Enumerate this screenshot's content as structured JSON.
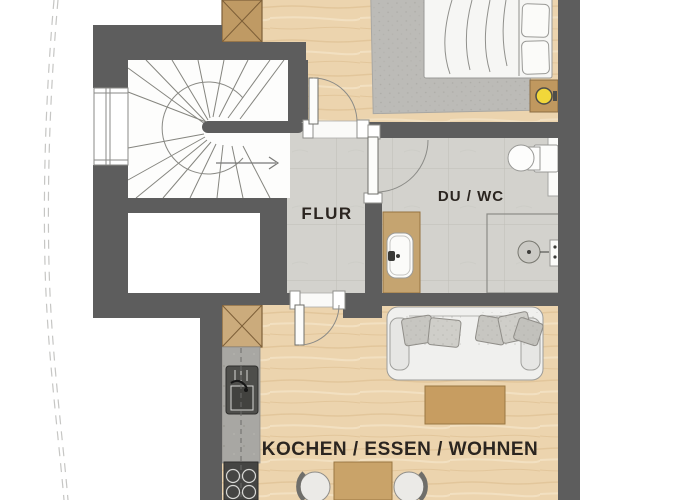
{
  "floorplan": {
    "rooms": {
      "hallway": {
        "label": "FLUR"
      },
      "bathroom": {
        "label": "DU / WC"
      },
      "living_kitchen": {
        "label": "KOCHEN / ESSEN / WOHNEN"
      }
    },
    "palette": {
      "wall": "#5d5d5d",
      "wood_floor": "#ecd4ae",
      "tile_floor": "#d3d2cd",
      "furniture_wood": "#c49e66",
      "cabinet_wood": "#bf9a64",
      "counter_gray": "#a8a7a3",
      "appliance_dark": "#484846",
      "rug_gray": "#bcbbb7",
      "white_goods": "#f4f4f2",
      "lamp_yellow": "#f1d73a",
      "label_text": "#2b2520",
      "boundary_dash": "#c6c6c4"
    },
    "fixtures": [
      "spiral-staircase",
      "window",
      "bed",
      "rug",
      "wardrobe",
      "nightstand-lamp",
      "toilet",
      "shower",
      "washbasin-vanity",
      "tall-cabinet",
      "kitchen-counter",
      "sink",
      "cooktop",
      "sofa",
      "coffee-table",
      "dining-table",
      "dining-chairs"
    ]
  }
}
